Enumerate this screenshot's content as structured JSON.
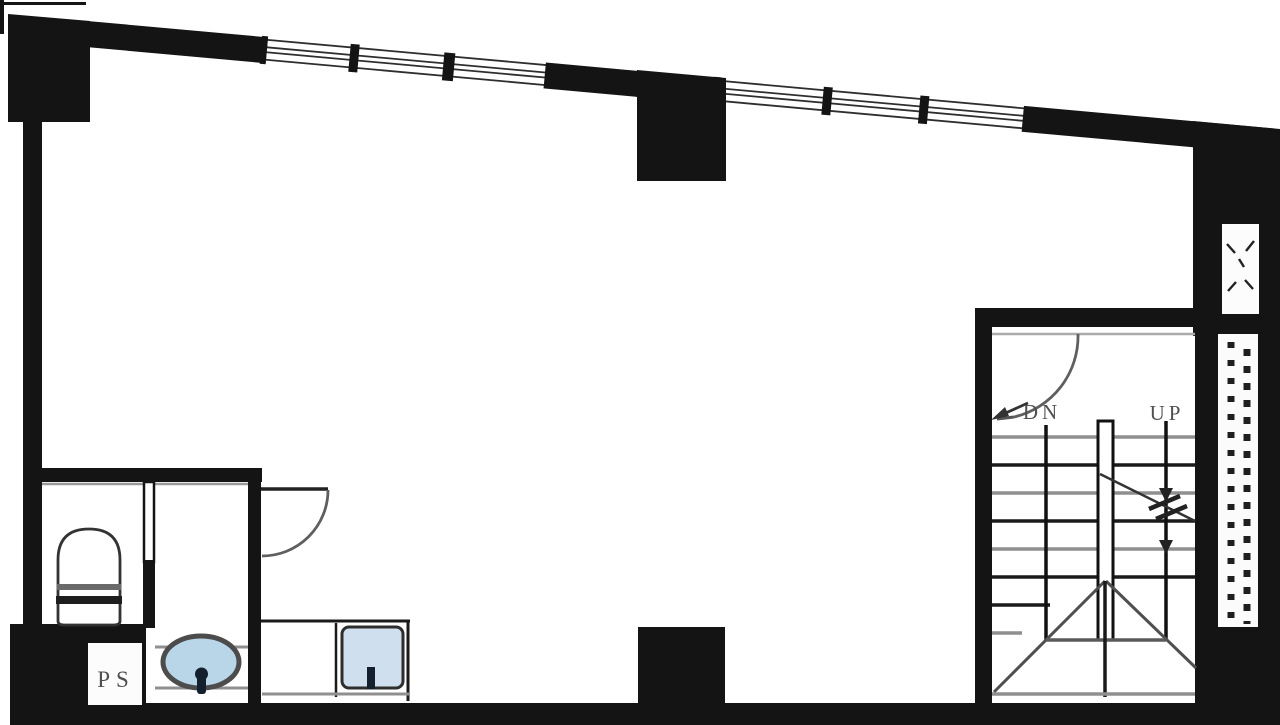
{
  "labels": {
    "stair_down": "DN",
    "stair_up": "UP",
    "pipe_shaft": "PS"
  },
  "colors": {
    "background": "#ffffff",
    "wall": "#141414",
    "line_dark": "#2b2b2b",
    "line_gray": "#8f8f8f",
    "door_arc": "#5f5f5f",
    "label_text": "#4f4f4f",
    "basin_water": "#b9d5e8",
    "sink_water": "#cfdfee"
  }
}
